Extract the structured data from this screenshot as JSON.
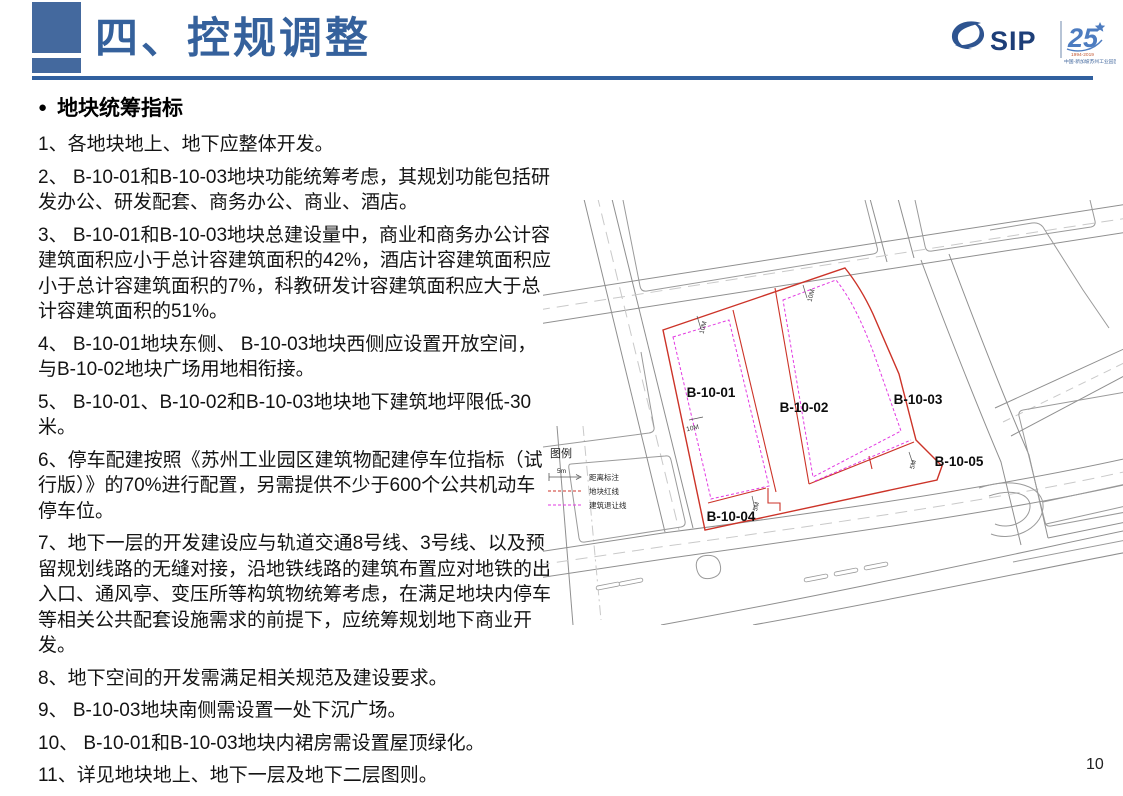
{
  "header": {
    "section_title": "四、控规调整",
    "accent_color": "#35619c"
  },
  "logo": {
    "brand": "SIP",
    "anniversary_number": "25",
    "dates": "1994-2019",
    "org_text": "中国-新加坡苏州工业园区"
  },
  "content": {
    "bullet": "●",
    "heading": "地块统筹指标",
    "paragraphs": [
      "1、各地块地上、地下应整体开发。",
      "2、 B-10-01和B-10-03地块功能统筹考虑，其规划功能包括研发办公、研发配套、商务办公、商业、酒店。",
      "3、 B-10-01和B-10-03地块总建设量中，商业和商务办公计容建筑面积应小于总计容建筑面积的42%，酒店计容建筑面积应小于总计容建筑面积的7%，科教研发计容建筑面积应大于总计容建筑面积的51%。",
      "4、 B-10-01地块东侧、 B-10-03地块西侧应设置开放空间，与B-10-02地块广场用地相衔接。",
      "5、 B-10-01、B-10-02和B-10-03地块地下建筑地坪限低-30米。",
      "6、停车配建按照《苏州工业园区建筑物配建停车位指标（试行版）》的70%进行配置，另需提供不少于600个公共机动车停车位。",
      "7、地下一层的开发建设应与轨道交通8号线、3号线、以及预留规划线路的无缝对接，沿地铁线路的建筑布置应对地铁的出入口、通风亭、变压所等构筑物统筹考虑，在满足地块内停车等相关公共配套设施需求的前提下，应统筹规划地下商业开发。",
      "8、地下空间的开发需满足相关规范及建设要求。",
      "9、 B-10-03地块南侧需设置一处下沉广场。",
      "10、 B-10-01和B-10-03地块内裙房需设置屋顶绿化。",
      "11、详见地块地上、地下一层及地下二层图则。"
    ]
  },
  "map": {
    "plots": [
      {
        "id": "B-10-01"
      },
      {
        "id": "B-10-02"
      },
      {
        "id": "B-10-03"
      },
      {
        "id": "B-10-04"
      },
      {
        "id": "B-10-05"
      }
    ],
    "dims": [
      "10M",
      "10M",
      "10M",
      "5M",
      "5M"
    ],
    "legend": {
      "title": "图例",
      "scale_label": "5m",
      "items": [
        {
          "label": "距离标注",
          "sample": "dimension-arrow",
          "color": "#555555"
        },
        {
          "label": "地块红线",
          "sample": "red-dashed",
          "color": "#cc3328"
        },
        {
          "label": "建筑退让线",
          "sample": "magenta-dashed",
          "color": "#e23ae2"
        }
      ]
    },
    "colors": {
      "plot_red_line": "#cc3328",
      "setback_line": "#e23ae2",
      "road_gray": "#8f8f8f"
    }
  },
  "footer": {
    "page_number": "10"
  }
}
